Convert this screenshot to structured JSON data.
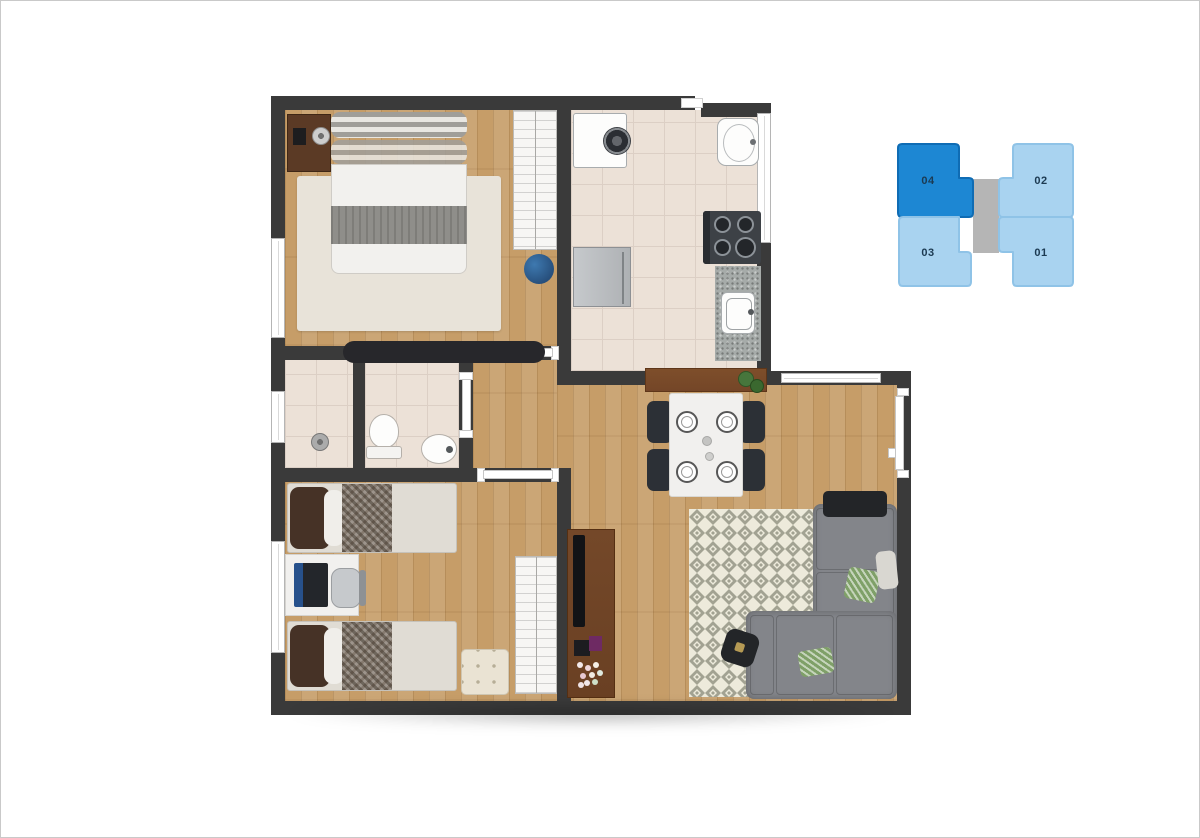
{
  "canvas": {
    "width": 1200,
    "height": 838,
    "background": "#ffffff",
    "frame_border": "#c9c9c9"
  },
  "floorplan": {
    "type": "apartment-floor-plan-top-view",
    "wall_color": "#3a3a3a",
    "wood_floor_color": "#c69d68",
    "tile_floor_color": "#ece1d7",
    "rug_living_colors": [
      "#a2a292",
      "#edeadb"
    ],
    "accent_pouf_color": "#2d5f92",
    "rooms": [
      "master-bedroom",
      "kitchen-laundry",
      "shower-room",
      "bathroom",
      "hall",
      "second-bedroom",
      "living-dining-room"
    ],
    "furniture": [
      "double-bed",
      "nightstand",
      "wardrobe",
      "blue-pouf",
      "dresser",
      "washing-machine",
      "laundry-tub",
      "stove",
      "counter-sink",
      "fridge",
      "sideboard",
      "shower-head",
      "toilet",
      "basin",
      "single-bed",
      "single-bed",
      "desk",
      "laptop",
      "desk-chair",
      "wardrobe",
      "tufted-ottoman",
      "dining-table",
      "dining-chairs",
      "diamond-rug",
      "sectional-sofa",
      "coffee-table",
      "tv-rack",
      "tv",
      "flowers"
    ]
  },
  "unit_locator": {
    "label_color": "#1c3a52",
    "corridor_color": "#b5b5b5",
    "units": [
      {
        "label": "04",
        "selected": true,
        "fill": "#1d87d3",
        "stroke": "#0f6cb4"
      },
      {
        "label": "02",
        "selected": false,
        "fill": "#a9d3f0",
        "stroke": "#8fc3e7"
      },
      {
        "label": "03",
        "selected": false,
        "fill": "#a9d3f0",
        "stroke": "#8fc3e7"
      },
      {
        "label": "01",
        "selected": false,
        "fill": "#a9d3f0",
        "stroke": "#8fc3e7"
      }
    ]
  }
}
